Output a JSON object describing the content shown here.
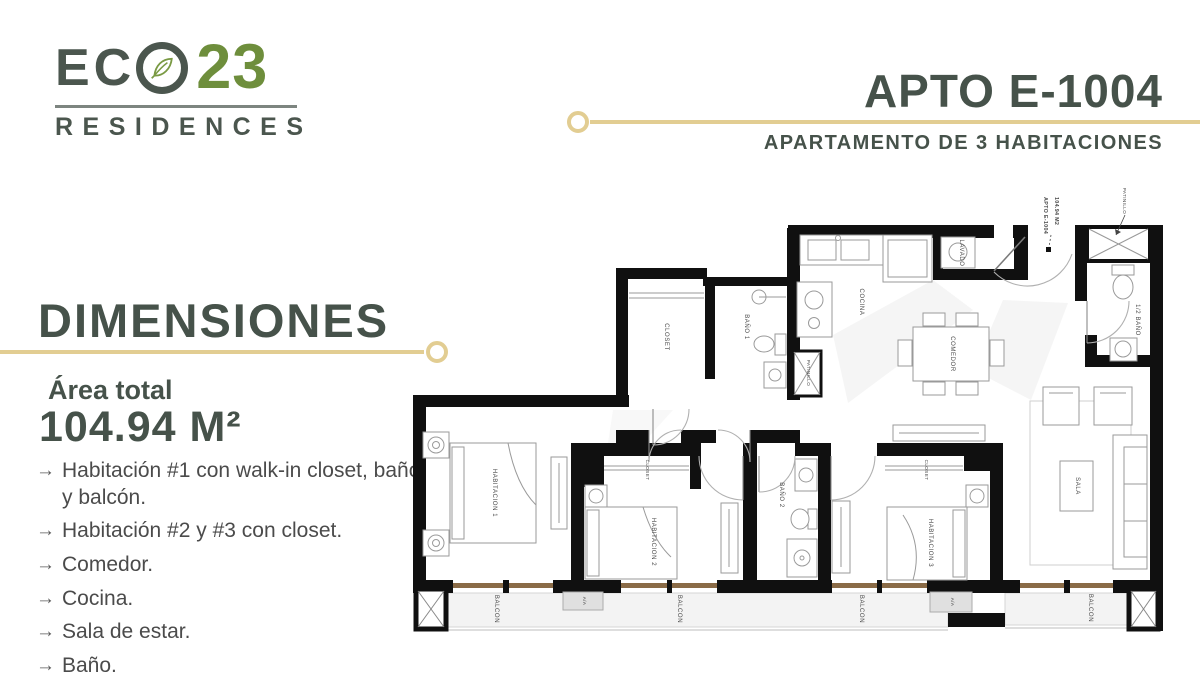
{
  "brand": {
    "name_prefix": "EC",
    "number": "23",
    "residences": "RESIDENCES"
  },
  "header": {
    "title": "APTO E-1004",
    "subtitle": "APARTAMENTO DE 3 HABITACIONES"
  },
  "dimensions": {
    "heading": "DIMENSIONES",
    "area_label": "Área total",
    "area_value": "104.94 M²",
    "features": [
      "Habitación #1 con walk-in closet, baño y balcón.",
      "Habitación #2 y #3 con closet.",
      "Comedor.",
      "Cocina.",
      "Sala de estar.",
      "Baño."
    ]
  },
  "plan": {
    "labels": {
      "patinillo": "PATINILLO",
      "apto_line1": "APTO E-1004",
      "apto_line2": "104.94 M2",
      "lavado": "LAVADO",
      "cocina": "COCINA",
      "comedor": "COMEDOR",
      "half_bano": "1/2 BAÑO",
      "closet": "CLOSET",
      "bano1": "BAÑO 1",
      "bano2": "BAÑO 2",
      "habitacion1": "HABITACION 1",
      "habitacion2": "HABITACION 2",
      "habitacion3": "HABITACION 3",
      "sala": "SALA",
      "balcon": "BALCON",
      "aa": "A/A"
    }
  },
  "colors": {
    "gold": "#e2cd92",
    "brand_green": "#6e8e3c",
    "text_dark": "#47524b"
  }
}
